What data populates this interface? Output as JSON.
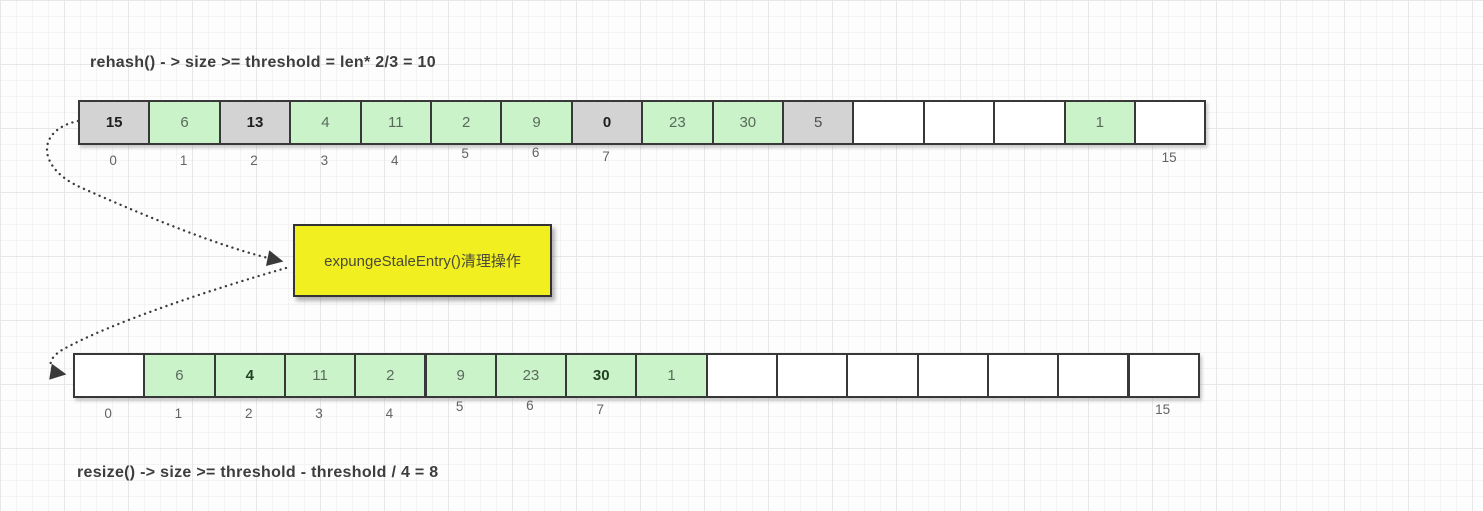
{
  "titles": {
    "top": "rehash() - > size >= threshold = len* 2/3 = 10",
    "bottom": "resize() -> size >= threshold - threshold / 4 = 8"
  },
  "callout": {
    "label": "expungeStaleEntry()清理操作"
  },
  "colors": {
    "stale_fill": "#d3d3d3",
    "live_fill": "#caf3ca",
    "empty_fill": "#ffffff",
    "cell_border": "#383838",
    "callout_fill": "#f2ef21",
    "arrow": "#3a3a3a"
  },
  "arrays": {
    "top": {
      "cells": [
        {
          "value": "15",
          "state": "stale",
          "bold": true
        },
        {
          "value": "6",
          "state": "live",
          "bold": false
        },
        {
          "value": "13",
          "state": "stale",
          "bold": true
        },
        {
          "value": "4",
          "state": "live",
          "bold": false
        },
        {
          "value": "11",
          "state": "live",
          "bold": false
        },
        {
          "value": "2",
          "state": "live",
          "bold": false
        },
        {
          "value": "9",
          "state": "live",
          "bold": false
        },
        {
          "value": "0",
          "state": "stale",
          "bold": true
        },
        {
          "value": "23",
          "state": "live",
          "bold": false
        },
        {
          "value": "30",
          "state": "live",
          "bold": false
        },
        {
          "value": "5",
          "state": "stale",
          "bold": false
        },
        {
          "value": "",
          "state": "empty",
          "bold": false
        },
        {
          "value": "",
          "state": "empty",
          "bold": false
        },
        {
          "value": "",
          "state": "empty",
          "bold": false
        },
        {
          "value": "1",
          "state": "live",
          "bold": false
        },
        {
          "value": "",
          "state": "empty",
          "bold": false
        }
      ],
      "index_labels": [
        {
          "text": "0",
          "cell": 0
        },
        {
          "text": "1",
          "cell": 1
        },
        {
          "text": "2",
          "cell": 2
        },
        {
          "text": "3",
          "cell": 3
        },
        {
          "text": "4",
          "cell": 4
        },
        {
          "text": "5",
          "cell": 5
        },
        {
          "text": "6",
          "cell": 6
        },
        {
          "text": "7",
          "cell": 7
        },
        {
          "text": "15",
          "cell": 15
        }
      ]
    },
    "bottom": {
      "cells": [
        {
          "value": "",
          "state": "empty",
          "bold": false
        },
        {
          "value": "6",
          "state": "live",
          "bold": false
        },
        {
          "value": "4",
          "state": "live",
          "bold": true
        },
        {
          "value": "11",
          "state": "live",
          "bold": false
        },
        {
          "value": "2",
          "state": "live",
          "bold": false
        },
        {
          "value": "9",
          "state": "live",
          "bold": false
        },
        {
          "value": "23",
          "state": "live",
          "bold": false
        },
        {
          "value": "30",
          "state": "live",
          "bold": true
        },
        {
          "value": "1",
          "state": "live",
          "bold": false
        },
        {
          "value": "",
          "state": "empty",
          "bold": false
        },
        {
          "value": "",
          "state": "empty",
          "bold": false
        },
        {
          "value": "",
          "state": "empty",
          "bold": false
        },
        {
          "value": "",
          "state": "empty",
          "bold": false
        },
        {
          "value": "",
          "state": "empty",
          "bold": false
        },
        {
          "value": "",
          "state": "empty",
          "bold": false
        },
        {
          "value": "",
          "state": "empty",
          "bold": false
        }
      ],
      "index_labels": [
        {
          "text": "0",
          "cell": 0
        },
        {
          "text": "1",
          "cell": 1
        },
        {
          "text": "2",
          "cell": 2
        },
        {
          "text": "3",
          "cell": 3
        },
        {
          "text": "4",
          "cell": 4
        },
        {
          "text": "5",
          "cell": 5
        },
        {
          "text": "6",
          "cell": 6
        },
        {
          "text": "7",
          "cell": 7
        },
        {
          "text": "15",
          "cell": 15
        }
      ]
    }
  }
}
